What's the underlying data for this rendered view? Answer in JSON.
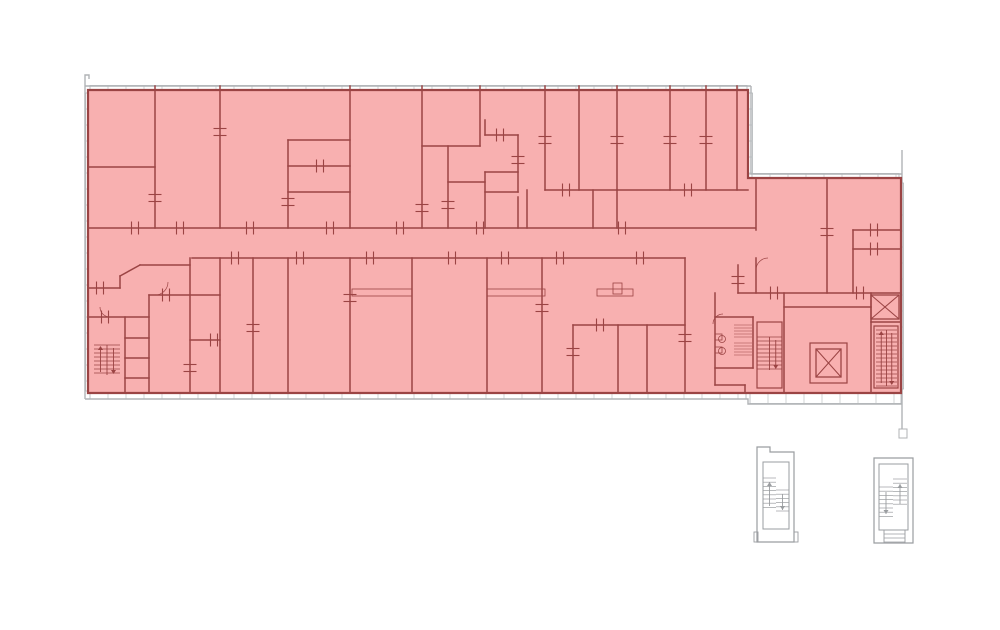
{
  "meta": {
    "type": "architectural-floor-plan",
    "canvas": {
      "width": 1000,
      "height": 630
    }
  },
  "colors": {
    "background": "#ffffff",
    "highlight_fill": "#f8b0b0",
    "highlight_border": "#9b4444",
    "wall": "#9b4444",
    "outline_gray": "#b0b3b6",
    "window_mullion": "#c6c9cc",
    "window_fill": "#ffffff",
    "detached_gray": "#9a9da0"
  },
  "floor_plan": {
    "highlight_polygon": [
      [
        88,
        90
      ],
      [
        748,
        90
      ],
      [
        748,
        178
      ],
      [
        901,
        178
      ],
      [
        901,
        393
      ],
      [
        88,
        393
      ]
    ],
    "outline_paths": [
      "M85,399 L85,75 L89,75 L89,79",
      "M85,86 L751,86",
      "M751,86 L751,174 L902,174",
      "M902,150 L902,429",
      "M85,399 L748,399 L748,404 L902,404"
    ],
    "outline_rects": [
      [
        899,
        429,
        8,
        9
      ]
    ],
    "window_bands": [
      {
        "x": 90,
        "y": 85.5,
        "w": 657,
        "h": 5,
        "dir": "h"
      },
      {
        "x": 747.5,
        "y": 93,
        "w": 5,
        "h": 81,
        "dir": "v"
      },
      {
        "x": 752,
        "y": 173.5,
        "w": 147,
        "h": 5,
        "dir": "h"
      },
      {
        "x": 898.5,
        "y": 183,
        "w": 5,
        "h": 206,
        "dir": "v"
      },
      {
        "x": 90,
        "y": 393.5,
        "w": 656,
        "h": 5.5,
        "dir": "h"
      },
      {
        "x": 750,
        "y": 393.5,
        "w": 151,
        "h": 10,
        "dir": "h"
      },
      {
        "x": 85.5,
        "y": 93,
        "w": 3,
        "h": 298,
        "dir": "v"
      }
    ],
    "walls": [
      [
        155,
        86,
        155,
        228
      ],
      [
        88,
        167,
        155,
        167
      ],
      [
        220,
        86,
        220,
        228
      ],
      [
        288,
        140,
        288,
        228
      ],
      [
        288,
        140,
        350,
        140
      ],
      [
        288,
        166,
        350,
        166
      ],
      [
        288,
        192,
        350,
        192
      ],
      [
        350,
        86,
        350,
        228
      ],
      [
        422,
        86,
        422,
        228
      ],
      [
        480,
        86,
        480,
        146
      ],
      [
        422,
        146,
        480,
        146
      ],
      [
        448,
        146,
        448,
        228
      ],
      [
        448,
        182,
        485,
        182
      ],
      [
        485,
        120,
        485,
        135
      ],
      [
        485,
        135,
        518,
        135
      ],
      [
        518,
        135,
        518,
        192
      ],
      [
        485,
        172,
        518,
        172
      ],
      [
        485,
        172,
        485,
        228
      ],
      [
        485,
        192,
        518,
        192
      ],
      [
        518,
        197,
        518,
        228
      ],
      [
        527,
        190,
        527,
        228
      ],
      [
        545,
        86,
        545,
        190
      ],
      [
        579,
        86,
        579,
        190
      ],
      [
        617,
        86,
        617,
        190
      ],
      [
        670,
        86,
        670,
        190
      ],
      [
        706,
        86,
        706,
        190
      ],
      [
        737,
        86,
        737,
        190
      ],
      [
        545,
        190,
        748,
        190
      ],
      [
        593,
        190,
        593,
        228
      ],
      [
        617,
        190,
        617,
        228
      ],
      [
        88,
        228,
        755,
        228
      ],
      [
        192,
        258,
        685,
        258
      ],
      [
        88,
        288,
        120,
        288
      ],
      [
        120,
        276,
        120,
        288
      ],
      [
        120,
        276,
        140,
        265
      ],
      [
        140,
        265,
        190,
        265
      ],
      [
        88,
        317,
        149,
        317
      ],
      [
        125,
        317,
        125,
        393
      ],
      [
        149,
        295,
        149,
        393
      ],
      [
        149,
        295,
        220,
        295
      ],
      [
        125,
        338,
        149,
        338
      ],
      [
        125,
        358,
        149,
        358
      ],
      [
        125,
        378,
        149,
        378
      ],
      [
        190,
        258,
        190,
        393
      ],
      [
        220,
        258,
        220,
        393
      ],
      [
        253,
        258,
        253,
        393
      ],
      [
        288,
        258,
        288,
        393
      ],
      [
        350,
        258,
        350,
        393
      ],
      [
        412,
        258,
        412,
        393
      ],
      [
        487,
        258,
        487,
        393
      ],
      [
        542,
        258,
        542,
        393
      ],
      [
        685,
        258,
        685,
        393
      ],
      [
        573,
        325,
        685,
        325
      ],
      [
        573,
        325,
        573,
        393
      ],
      [
        618,
        325,
        618,
        393
      ],
      [
        647,
        325,
        647,
        393
      ],
      [
        190,
        340,
        220,
        340
      ],
      [
        756,
        178,
        756,
        230
      ],
      [
        756,
        258,
        756,
        293
      ],
      [
        827,
        178,
        827,
        293
      ],
      [
        853,
        230,
        853,
        293
      ],
      [
        853,
        230,
        901,
        230
      ],
      [
        853,
        249,
        901,
        249
      ],
      [
        738,
        265,
        738,
        293
      ],
      [
        738,
        293,
        901,
        293
      ],
      [
        715,
        293,
        715,
        385
      ],
      [
        715,
        317,
        753,
        317
      ],
      [
        715,
        368,
        753,
        368
      ],
      [
        753,
        317,
        753,
        368
      ],
      [
        715,
        385,
        745,
        385
      ],
      [
        745,
        385,
        745,
        393
      ],
      [
        784,
        293,
        784,
        393
      ],
      [
        784,
        307,
        871,
        307
      ],
      [
        871,
        293,
        871,
        393
      ],
      [
        871,
        322,
        901,
        322
      ]
    ],
    "beams": [
      [
        352,
        289,
        60,
        7
      ],
      [
        487,
        289,
        58,
        7
      ],
      [
        597,
        289,
        36,
        7
      ],
      [
        613,
        283,
        9,
        11
      ]
    ],
    "stair_enclosures": [
      [
        757,
        322,
        25,
        66
      ],
      [
        874,
        326,
        24,
        62
      ]
    ],
    "stairs": [
      {
        "x": 94,
        "y": 345,
        "w": 26,
        "h": 30,
        "arrow": "both"
      },
      {
        "x": 757,
        "y": 337,
        "w": 25,
        "h": 33,
        "arrow": "down"
      },
      {
        "x": 876,
        "y": 330,
        "w": 21,
        "h": 56,
        "arrow": "both"
      }
    ],
    "elevators": [
      {
        "x": 871,
        "y": 295,
        "w": 28,
        "h": 24,
        "shell": null
      },
      {
        "x": 816,
        "y": 349,
        "w": 25,
        "h": 28,
        "shell": [
          810,
          343,
          37,
          40
        ]
      }
    ],
    "wc": {
      "hatches": [
        [
          734,
          325,
          18,
          12
        ],
        [
          734,
          343,
          18,
          12
        ]
      ],
      "circles": [
        [
          722,
          339,
          3.5
        ],
        [
          722,
          351,
          3.5
        ]
      ],
      "rects": [
        [
          715,
          334,
          7,
          6
        ],
        [
          715,
          347,
          7,
          6
        ]
      ]
    },
    "door_arcs": [
      {
        "cx": 168,
        "cy": 295,
        "r": 13,
        "q": 2
      },
      {
        "cx": 100,
        "cy": 317,
        "r": 10,
        "q": 1
      },
      {
        "cx": 756,
        "cy": 258,
        "r": 12,
        "q": 4
      },
      {
        "cx": 713,
        "cy": 314,
        "r": 10,
        "q": 4
      }
    ],
    "door_ticks": {
      "v": [
        [
          135,
          228
        ],
        [
          180,
          228
        ],
        [
          250,
          228
        ],
        [
          330,
          228
        ],
        [
          400,
          228
        ],
        [
          480,
          228
        ],
        [
          622,
          228
        ],
        [
          235,
          258
        ],
        [
          300,
          258
        ],
        [
          370,
          258
        ],
        [
          452,
          258
        ],
        [
          505,
          258
        ],
        [
          560,
          258
        ],
        [
          640,
          258
        ],
        [
          166,
          295
        ],
        [
          566,
          190
        ],
        [
          688,
          190
        ],
        [
          105,
          317
        ],
        [
          100,
          288
        ],
        [
          320,
          166
        ],
        [
          500,
          135
        ],
        [
          874,
          230
        ],
        [
          874,
          249
        ],
        [
          860,
          293
        ],
        [
          774,
          293
        ],
        [
          600,
          325
        ],
        [
          214,
          340
        ]
      ],
      "h": [
        [
          155,
          198
        ],
        [
          220,
          132
        ],
        [
          350,
          298
        ],
        [
          422,
          208
        ],
        [
          542,
          308
        ],
        [
          685,
          338
        ],
        [
          827,
          232
        ],
        [
          253,
          328
        ],
        [
          288,
          202
        ],
        [
          573,
          352
        ],
        [
          190,
          368
        ],
        [
          738,
          280
        ],
        [
          448,
          205
        ],
        [
          518,
          160
        ],
        [
          545,
          140
        ],
        [
          617,
          140
        ],
        [
          670,
          140
        ],
        [
          706,
          140
        ]
      ]
    },
    "detached_stairwells": [
      {
        "name": "stairwell-south-a",
        "outline": "M757,542 L757,447 L770,447 L770,452 L794,452 L794,542 Z",
        "inner": [
          763,
          462,
          26,
          67
        ],
        "flights": [
          [
            763,
            478,
            13,
            30
          ],
          [
            776,
            490,
            13,
            22
          ]
        ],
        "arrows": [
          {
            "x": 769.5,
            "y1": 506,
            "y2": 482
          },
          {
            "x": 782.5,
            "y1": 494,
            "y2": 510
          }
        ],
        "feet": [
          [
            754,
            532,
            4,
            10
          ],
          [
            794,
            532,
            4,
            10
          ]
        ],
        "base": null
      },
      {
        "name": "stairwell-south-b",
        "outline": "M874,543 L874,458 L913,458 L913,543 Z",
        "inner": [
          879,
          464,
          29,
          66
        ],
        "flights": [
          [
            879,
            487,
            14,
            31
          ],
          [
            893,
            479,
            14,
            29
          ]
        ],
        "arrows": [
          {
            "x": 886,
            "y1": 492,
            "y2": 514
          },
          {
            "x": 900,
            "y1": 504,
            "y2": 484
          }
        ],
        "feet": [],
        "base": {
          "rect": [
            884,
            530,
            21,
            13
          ],
          "lines": [
            534,
            538,
            542
          ]
        }
      }
    ]
  }
}
